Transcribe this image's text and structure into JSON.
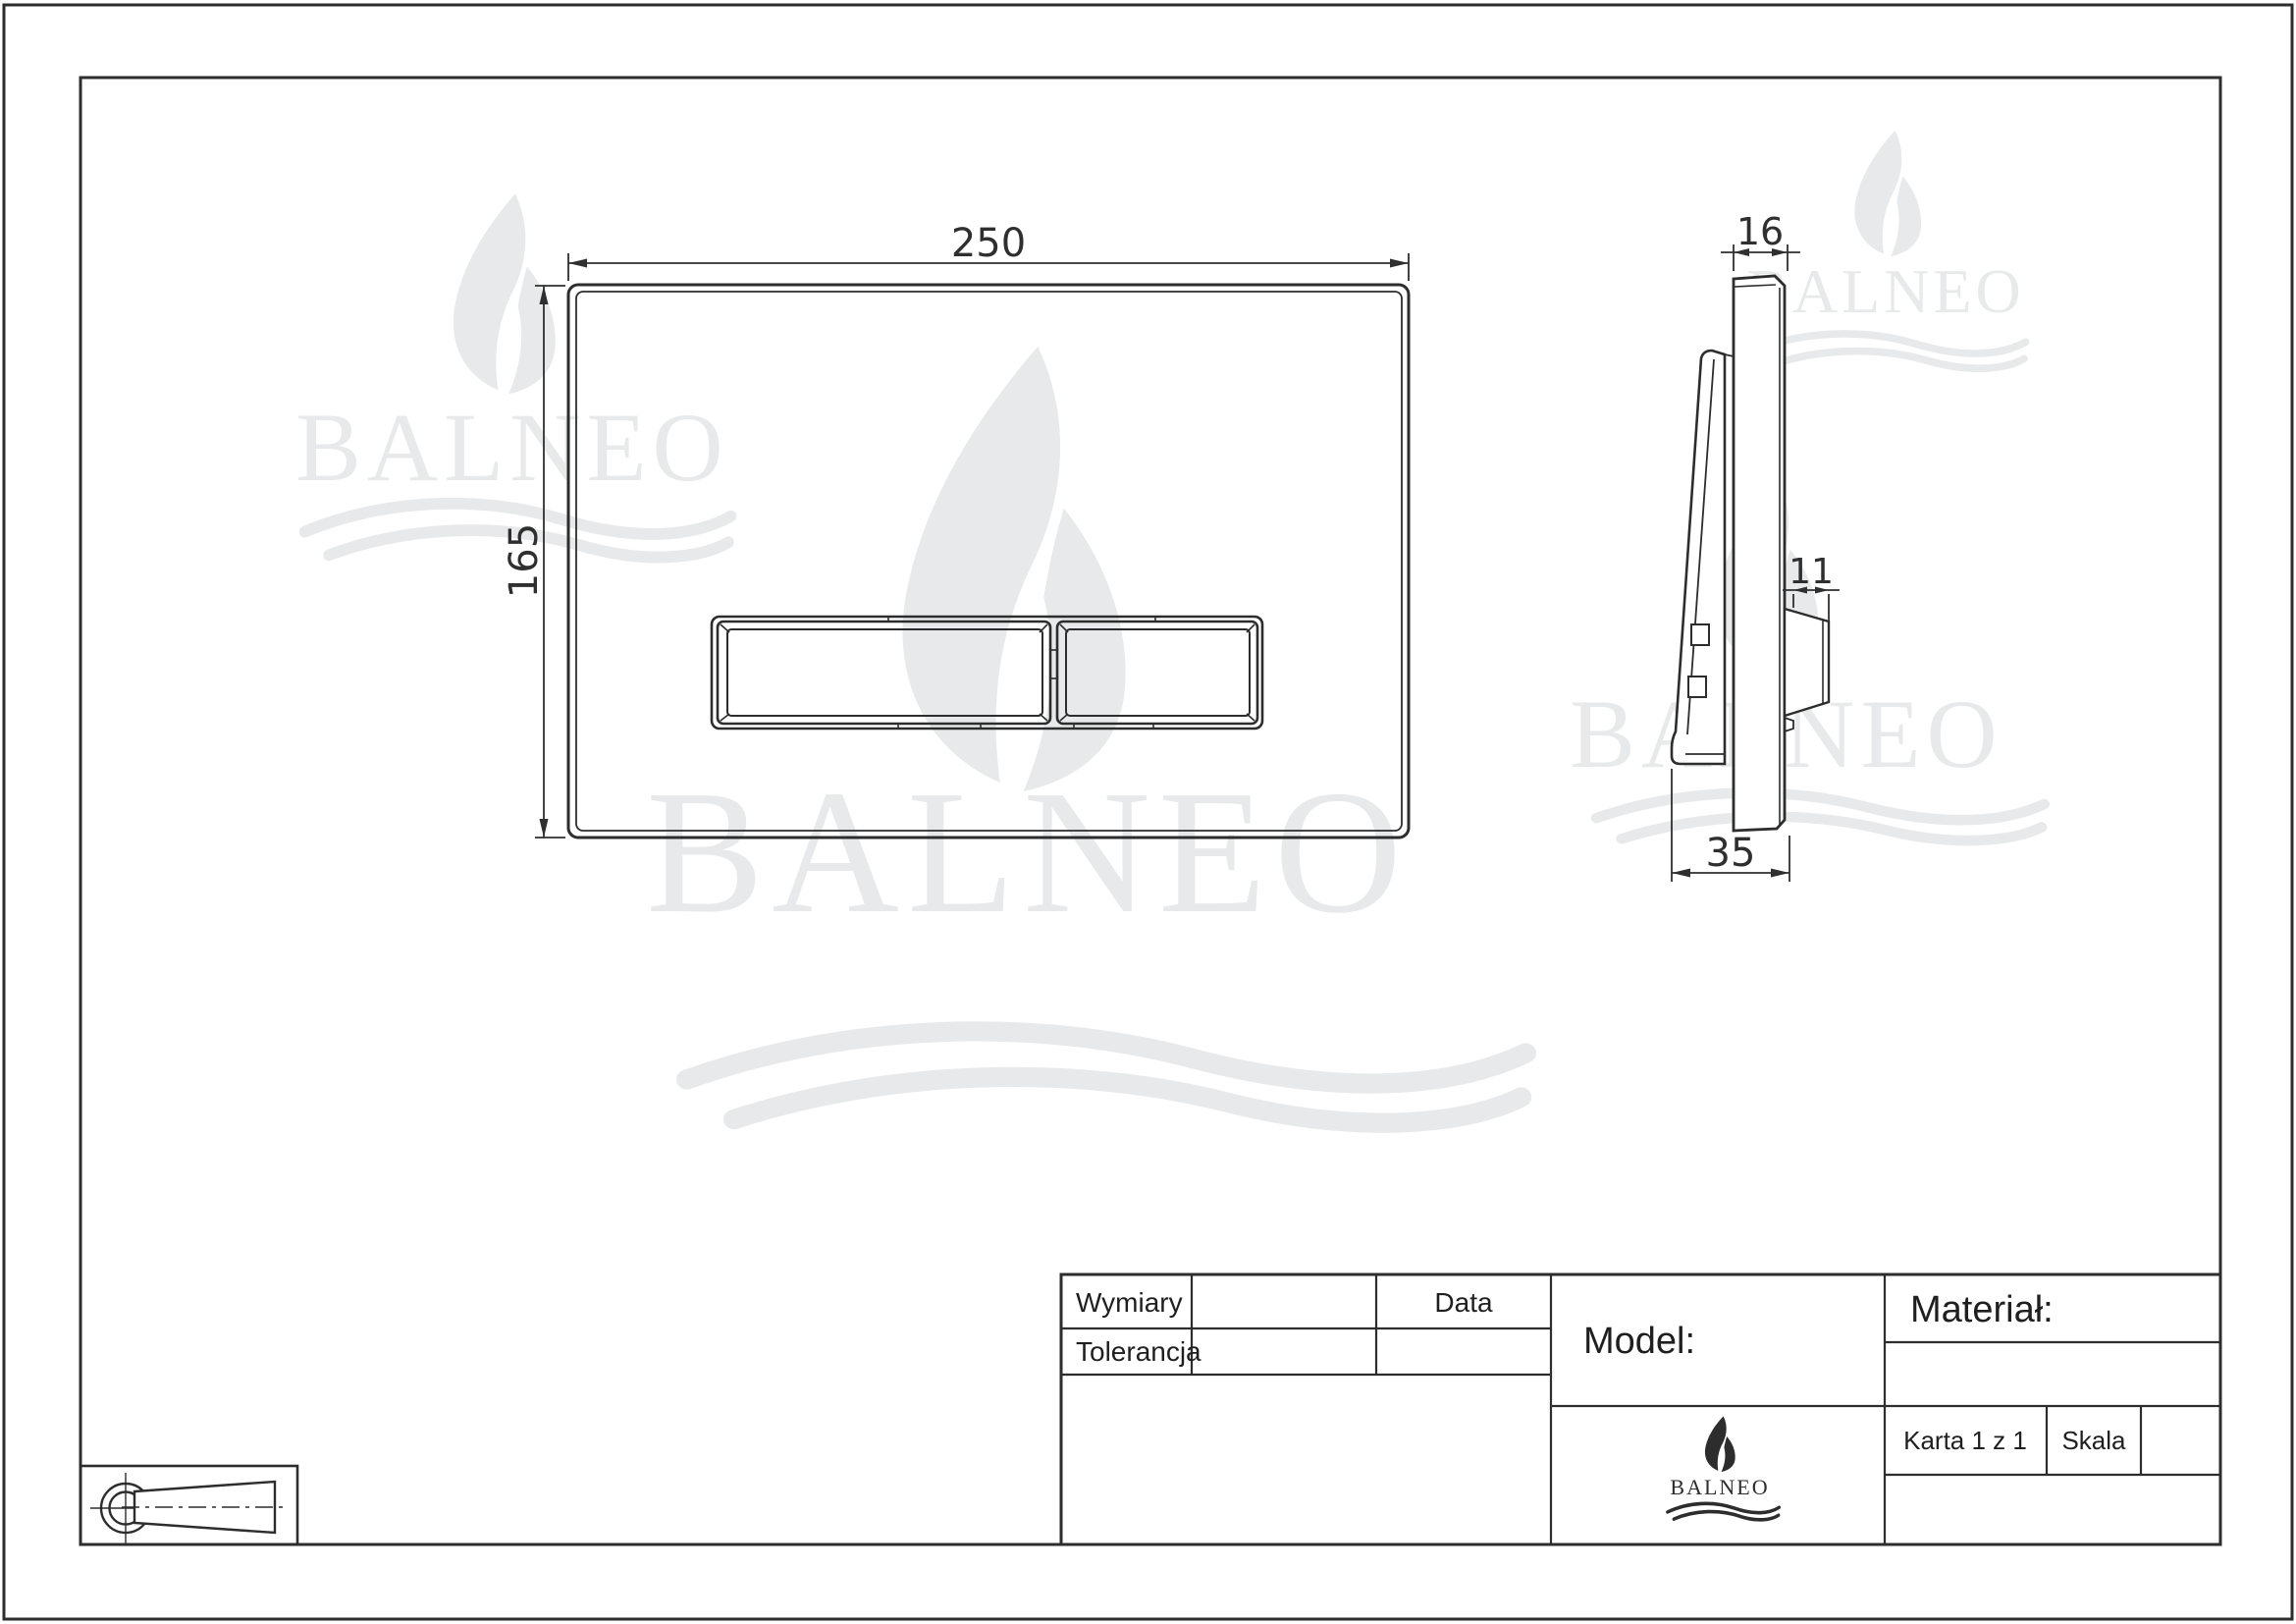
{
  "sheet": {
    "background": "#ffffff",
    "line_color": "#2d2d2d",
    "watermark_color": "#e8e9ea"
  },
  "brand": {
    "wordmark": "BALNEO"
  },
  "views": {
    "front": {
      "width_label": "250",
      "height_label": "165"
    },
    "side": {
      "thickness_label": "16",
      "button_depth_label": "11",
      "base_depth_label": "35"
    }
  },
  "title_block": {
    "wymiary_label": "Wymiary",
    "tolerancja_label": "Tolerancja",
    "data_label": "Data",
    "model_label": "Model:",
    "material_label": "Materiał:",
    "karta_label": "Karta 1 z 1",
    "skala_label": "Skala"
  }
}
